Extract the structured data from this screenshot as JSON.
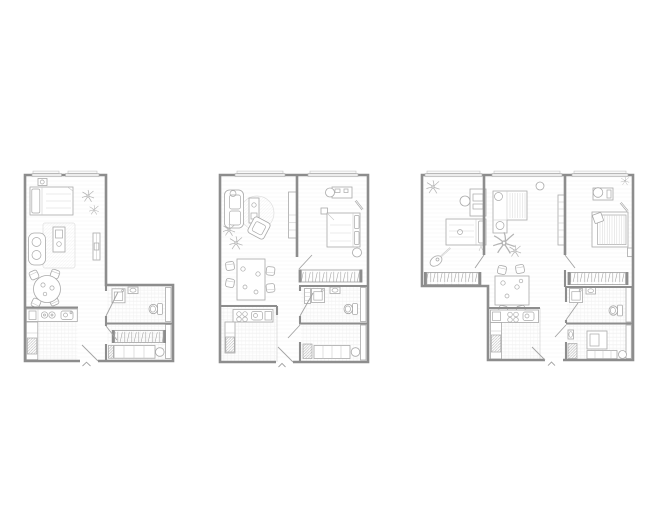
{
  "canvas": {
    "width": 660,
    "height": 530,
    "background": "#ffffff"
  },
  "style": {
    "background": "#ffffff",
    "wall_color": "#8d8d8d",
    "furniture_color": "#a9a9a9",
    "door_color": "#a2a2a2",
    "hatch_color": "#a8a8a8"
  },
  "figure": {
    "type": "architectural-floor-plans",
    "plan_count": 3,
    "entry_marker_glyph": "^"
  },
  "plans": [
    {
      "id": "plan-1",
      "layout": "L-shaped studio",
      "transform": "translate(25,175)",
      "rooms": [
        "living-sleeping-room",
        "kitchen",
        "hallway",
        "bathroom",
        "storage-wardrobe"
      ],
      "furniture": [
        "bed",
        "nightstand-lamp",
        "plants",
        "sofa",
        "rug",
        "coffee-table",
        "tv-sideboard",
        "round-dining-table",
        "chairs",
        "kitchen-counter",
        "hob",
        "sink",
        "fridge",
        "washing-machine",
        "wash-basin",
        "toilet",
        "clothes-rail",
        "shelving",
        "shoe-cabinet"
      ]
    },
    {
      "id": "plan-2",
      "layout": "one-bedroom",
      "transform": "translate(220,175)",
      "rooms": [
        "living-room",
        "bedroom",
        "dining-area",
        "kitchen",
        "hallway",
        "bathroom",
        "storage"
      ],
      "furniture": [
        "sofa",
        "round-rug",
        "coffee-table",
        "armchair",
        "plants",
        "tv-cabinet",
        "double-bed",
        "pillows",
        "desk",
        "desk-chair",
        "mirror",
        "pouf",
        "wardrobe-rail",
        "dining-table",
        "chairs",
        "kitchen-counter",
        "hob",
        "sink",
        "fridge",
        "washing-machine",
        "wash-basin",
        "toilet",
        "shelving",
        "shoe-cabinet"
      ]
    },
    {
      "id": "plan-3",
      "layout": "two-bedroom",
      "transform": "translate(422,175)",
      "rooms": [
        "bedroom-1",
        "living-room",
        "bedroom-2",
        "dining-area",
        "kitchen",
        "hallway",
        "bathroom",
        "storage"
      ],
      "furniture": [
        "single-bed",
        "desk",
        "desk-chair",
        "guitar",
        "plants",
        "corner-sofa",
        "side-table",
        "bookshelf",
        "double-bed",
        "pillow",
        "mirror",
        "nightstand",
        "wardrobe-rail",
        "dining-table",
        "chairs",
        "kitchen-counter",
        "hob",
        "sink",
        "fridge",
        "washing-machine",
        "wash-basin",
        "toilet",
        "ottoman",
        "shelving",
        "shoe-cabinet"
      ]
    }
  ]
}
